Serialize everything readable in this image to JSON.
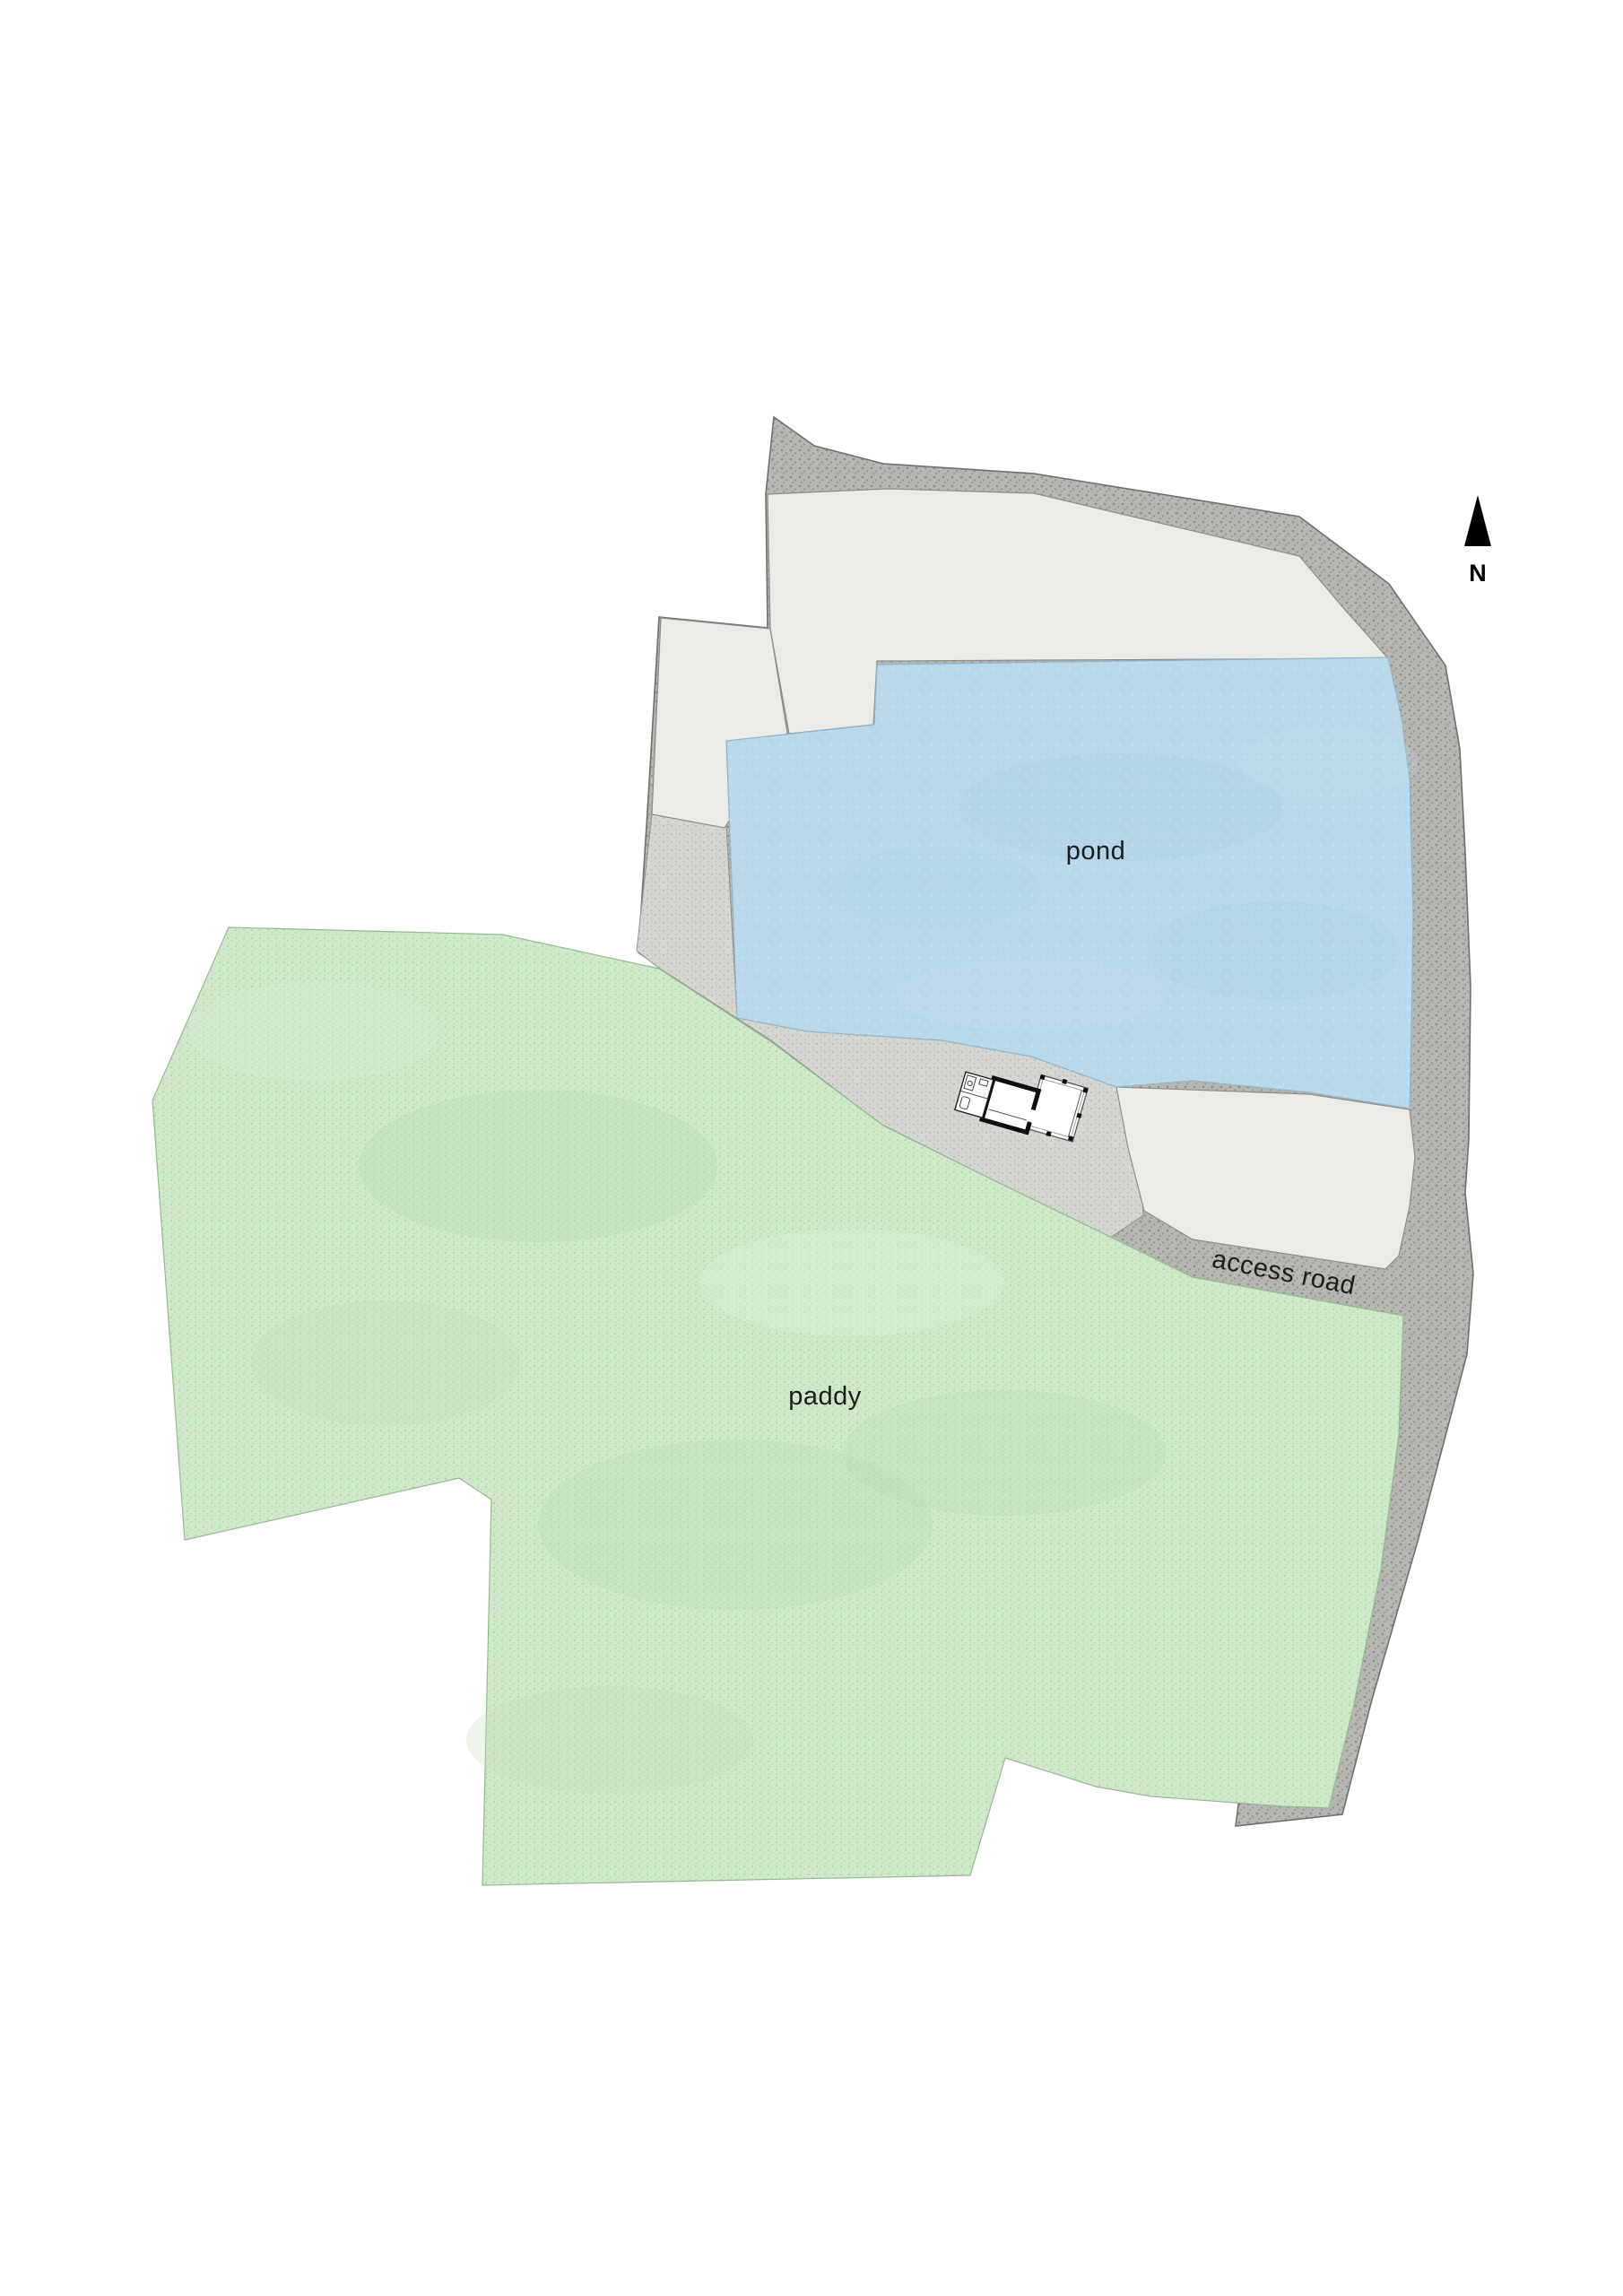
{
  "compass": {
    "label": "N",
    "color": "#000000"
  },
  "regions": {
    "pond": {
      "label": "pond",
      "color": "#b9d8ea"
    },
    "paddy": {
      "label": "paddy",
      "color": "#cfe9ca"
    },
    "access_road": {
      "label": "access road"
    },
    "perimeter_road": {
      "color": "#b7b7b3"
    },
    "fields": {
      "color": "#ebebe8"
    },
    "path_pad": {
      "color": "#d6d6d2"
    }
  },
  "building": {
    "wall_color": "#0f0f0f"
  },
  "text_color": "#1c1c1c"
}
